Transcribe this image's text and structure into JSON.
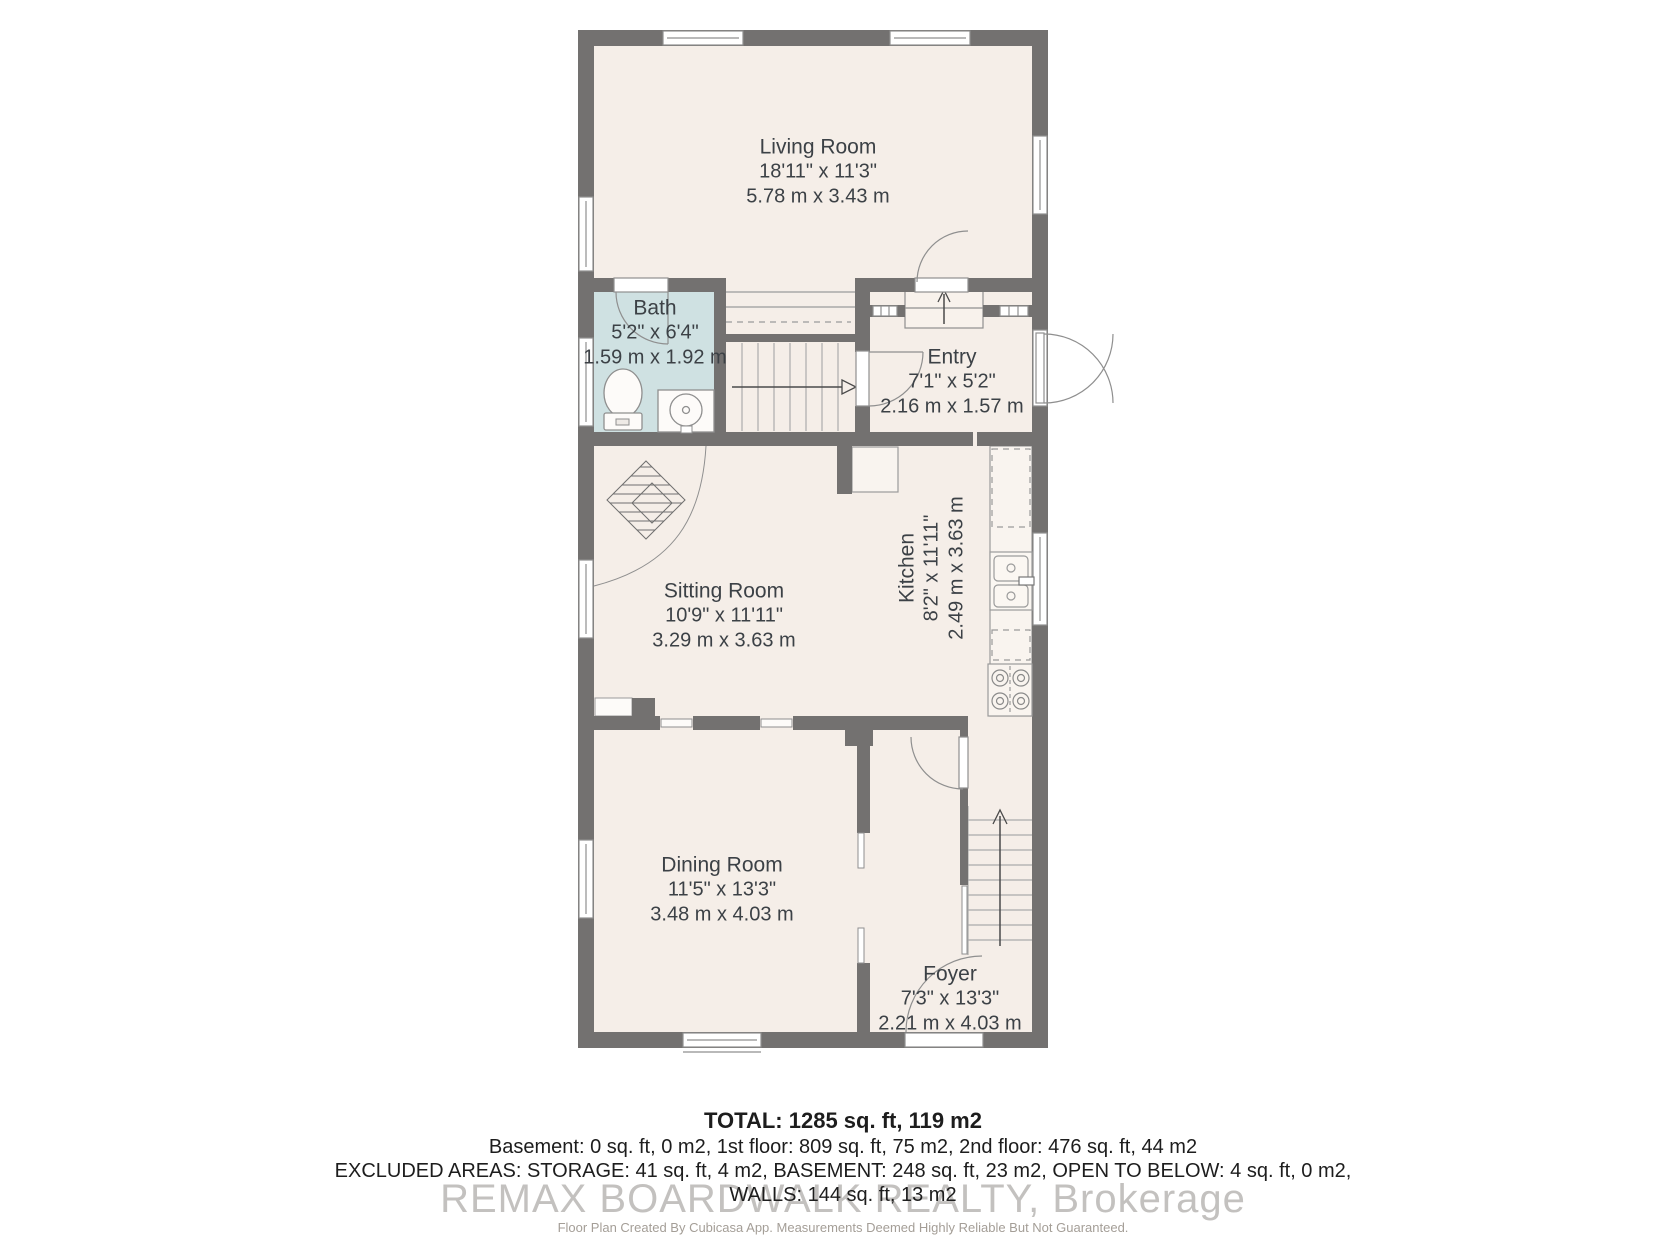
{
  "rooms": {
    "living": {
      "name": "Living Room",
      "imperial": "18'11\" x 11'3\"",
      "metric": "5.78 m x 3.43 m"
    },
    "bath": {
      "name": "Bath",
      "imperial": "5'2\" x 6'4\"",
      "metric": "1.59 m x 1.92 m"
    },
    "entry": {
      "name": "Entry",
      "imperial": "7'1\" x 5'2\"",
      "metric": "2.16 m x 1.57 m"
    },
    "sitting": {
      "name": "Sitting Room",
      "imperial": "10'9\" x 11'11\"",
      "metric": "3.29 m x 3.63 m"
    },
    "kitchen": {
      "name": "Kitchen",
      "imperial": "8'2\" x 11'11\"",
      "metric": "2.49 m x 3.63 m"
    },
    "dining": {
      "name": "Dining Room",
      "imperial": "11'5\" x 13'3\"",
      "metric": "3.48 m x 4.03 m"
    },
    "foyer": {
      "name": "Foyer",
      "imperial": "7'3\" x 13'3\"",
      "metric": "2.21 m x 4.03 m"
    }
  },
  "summary": {
    "total": "TOTAL: 1285 sq. ft, 119 m2",
    "floors": "Basement: 0 sq. ft, 0 m2, 1st floor: 809 sq. ft, 75 m2, 2nd floor: 476 sq. ft, 44 m2",
    "excluded": "EXCLUDED AREAS: STORAGE: 41 sq. ft, 4 m2, BASEMENT: 248 sq. ft, 23 m2, OPEN TO BELOW: 4 sq. ft, 0 m2,",
    "walls": "WALLS: 144 sq. ft, 13 m2"
  },
  "watermark": "REMAX BOARDWALK REALTY, Brokerage",
  "footnote": "Floor Plan Created By Cubicasa App. Measurements Deemed Highly Reliable But Not Guaranteed.",
  "colors": {
    "wall": "#737170",
    "floor": "#f5eee8",
    "bath_floor": "#cfe1e2",
    "label_text": "#3c4146",
    "fixture_stroke": "#8f8f8f"
  }
}
